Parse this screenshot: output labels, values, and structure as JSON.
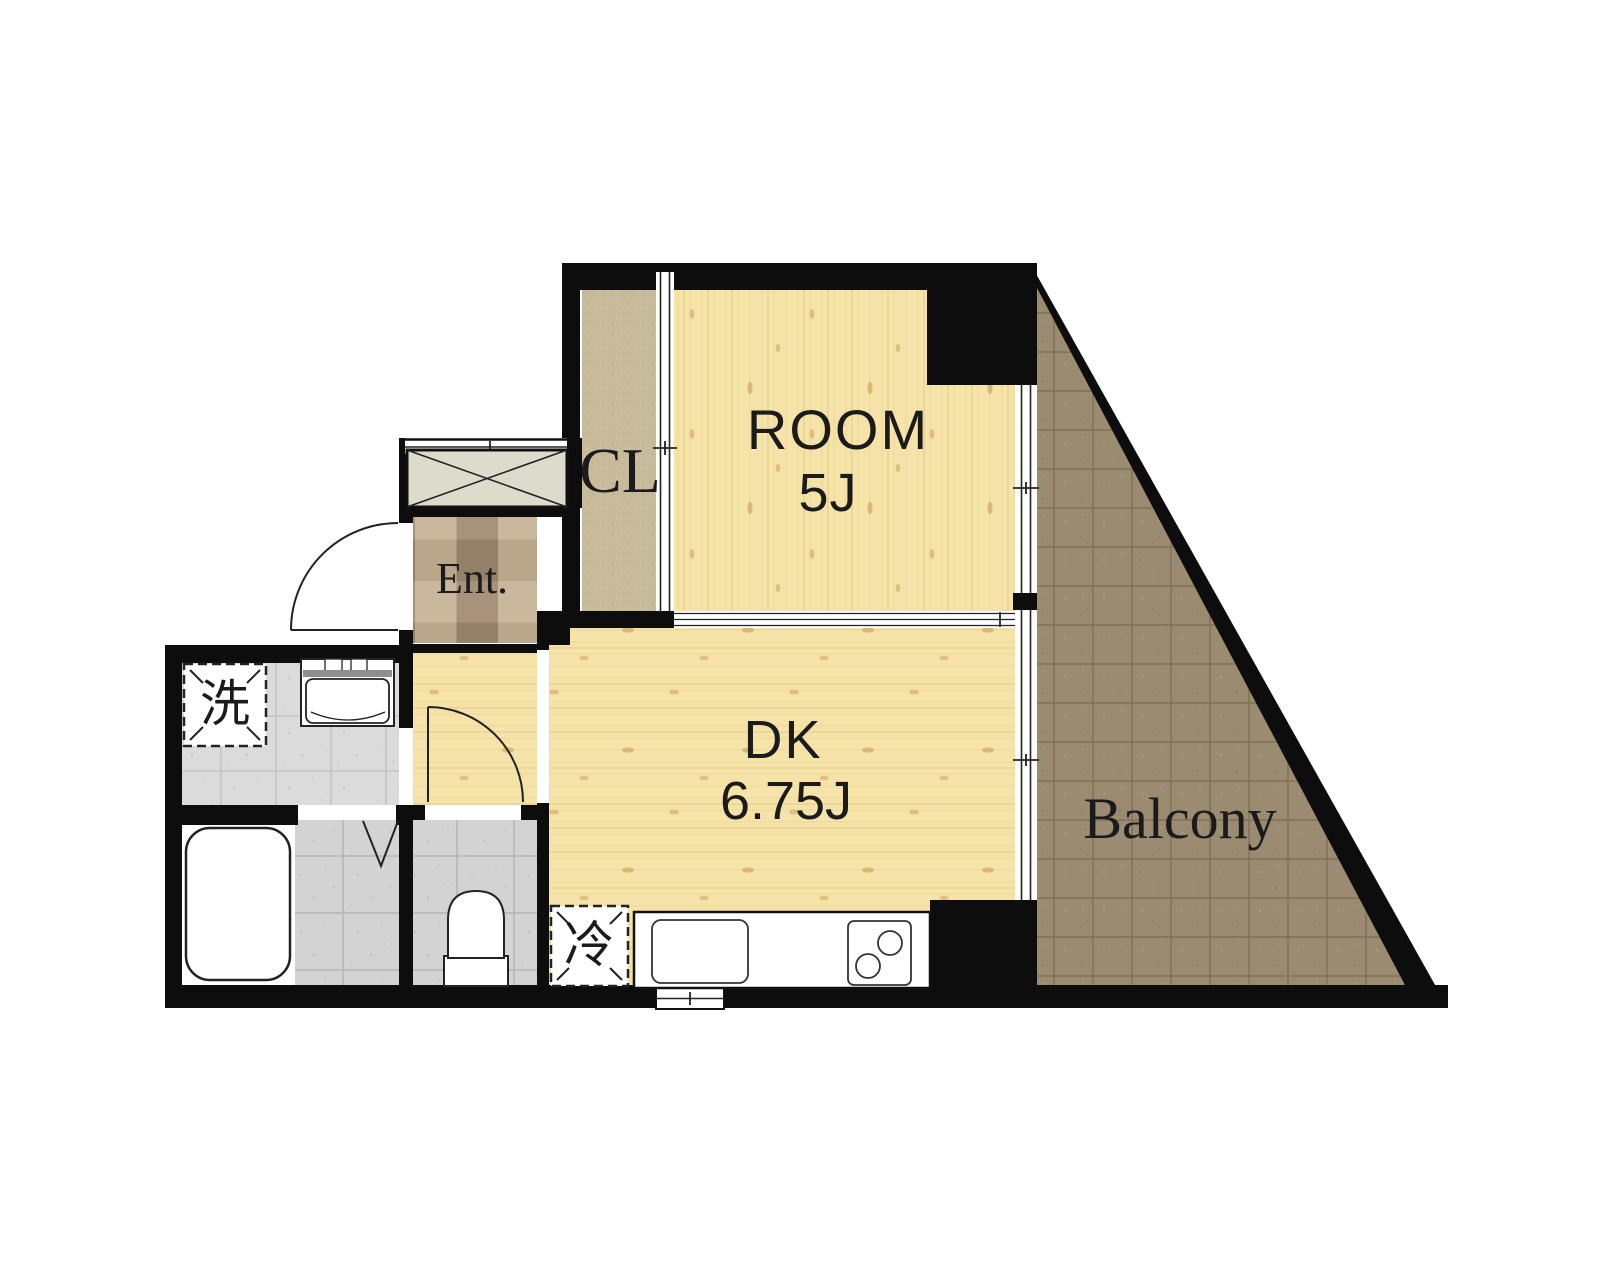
{
  "floor_plan": {
    "labels": {
      "room": {
        "name": "ROOM",
        "size": "5J"
      },
      "dining_kitchen": {
        "name": "DK",
        "size": "6.75J"
      },
      "closet": "CL",
      "entrance": "Ent.",
      "balcony": "Balcony",
      "washing_machine": "洗",
      "refrigerator": "冷"
    },
    "colors": {
      "wall": "#0d0d0d",
      "wood_floor": "#f5e3a9",
      "closet_floor": "#c8bb9c",
      "balcony_tile": "#9a8b71",
      "entrance_tile": "#b3a188",
      "washroom_tile": "#dbdbdb",
      "bathroom_tile": "#d3d3d3",
      "fixture_fill": "#ffffff",
      "label_text": "#1b1b1b"
    }
  }
}
